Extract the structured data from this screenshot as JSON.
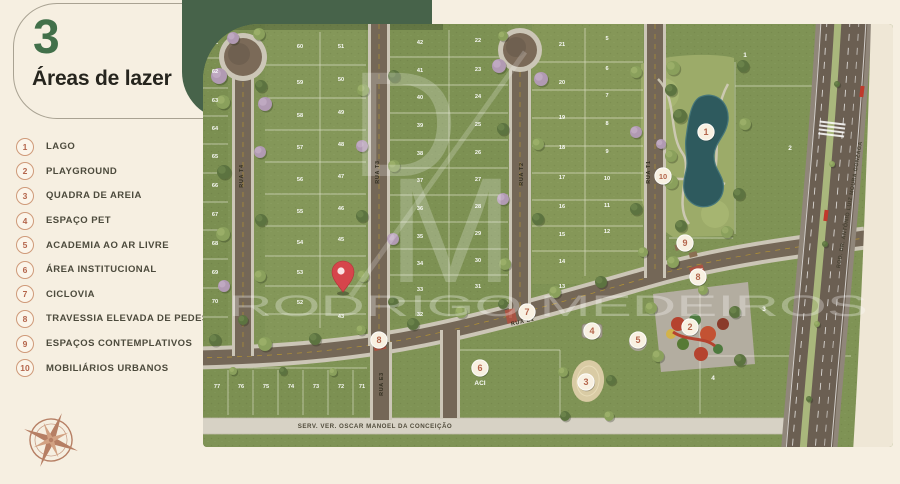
{
  "panel": {
    "section_number": "3",
    "title": "Áreas de lazer",
    "legend": [
      {
        "num": "1",
        "label": "LAGO"
      },
      {
        "num": "2",
        "label": "PLAYGROUND"
      },
      {
        "num": "3",
        "label": "QUADRA DE AREIA"
      },
      {
        "num": "4",
        "label": "ESPAÇO PET"
      },
      {
        "num": "5",
        "label": "ACADEMIA AO AR LIVRE"
      },
      {
        "num": "6",
        "label": "ÁREA INSTITUCIONAL"
      },
      {
        "num": "7",
        "label": "CICLOVIA"
      },
      {
        "num": "8",
        "label": "TRAVESSIA ELEVADA DE PEDESTRE"
      },
      {
        "num": "9",
        "label": "ESPAÇOS CONTEMPLATIVOS"
      },
      {
        "num": "10",
        "label": "MOBILIÁRIOS URBANOS"
      }
    ]
  },
  "watermark": {
    "monogram_d": "D",
    "monogram_m": "M",
    "name": "RODRIGO MEDEIROS"
  },
  "map": {
    "streets": [
      {
        "name": "RUA T4",
        "x": 40,
        "y": 152,
        "rot": -90,
        "cls": "street"
      },
      {
        "name": "RUA T3",
        "x": 176,
        "y": 148,
        "rot": -90,
        "cls": "street"
      },
      {
        "name": "RUA T2",
        "x": 320,
        "y": 150,
        "rot": -90,
        "cls": "street"
      },
      {
        "name": "RUA T1",
        "x": 447,
        "y": 148,
        "rot": -90,
        "cls": "street"
      },
      {
        "name": "RUA E1",
        "x": 320,
        "y": 299,
        "rot": -13,
        "cls": "street"
      },
      {
        "name": "RUA E3",
        "x": 180,
        "y": 360,
        "rot": -90,
        "cls": "street"
      },
      {
        "name": "SERV. VER. OSCAR MANOEL DA CONCEIÇÃO",
        "x": 172,
        "y": 404,
        "rot": 0,
        "cls": "serv"
      },
      {
        "name": "ROD. DR. ANTÔNIO LUIZ MOURA GONZAGA",
        "x": 648,
        "y": 181,
        "rot": -80,
        "cls": "rod"
      }
    ],
    "markers": [
      {
        "label": "1",
        "x": 503,
        "y": 108
      },
      {
        "label": "2",
        "x": 487,
        "y": 303
      },
      {
        "label": "3",
        "x": 383,
        "y": 358
      },
      {
        "label": "4",
        "x": 389,
        "y": 307
      },
      {
        "label": "5",
        "x": 435,
        "y": 316
      },
      {
        "label": "6",
        "x": 277,
        "y": 344
      },
      {
        "label": "7",
        "x": 324,
        "y": 288
      },
      {
        "label": "8",
        "x": 176,
        "y": 316
      },
      {
        "label": "8",
        "x": 495,
        "y": 253
      },
      {
        "label": "9",
        "x": 482,
        "y": 219
      },
      {
        "label": "10",
        "x": 460,
        "y": 152
      }
    ],
    "lots": [
      {
        "n": "61",
        "x": 12,
        "y": 20
      },
      {
        "n": "62",
        "x": 12,
        "y": 49
      },
      {
        "n": "63",
        "x": 12,
        "y": 78
      },
      {
        "n": "64",
        "x": 12,
        "y": 106
      },
      {
        "n": "65",
        "x": 12,
        "y": 134
      },
      {
        "n": "66",
        "x": 12,
        "y": 163
      },
      {
        "n": "67",
        "x": 12,
        "y": 192
      },
      {
        "n": "68",
        "x": 12,
        "y": 221
      },
      {
        "n": "69",
        "x": 12,
        "y": 250
      },
      {
        "n": "70",
        "x": 12,
        "y": 279
      },
      {
        "n": "77",
        "x": 14,
        "y": 364
      },
      {
        "n": "76",
        "x": 38,
        "y": 364
      },
      {
        "n": "75",
        "x": 63,
        "y": 364
      },
      {
        "n": "74",
        "x": 88,
        "y": 364
      },
      {
        "n": "73",
        "x": 113,
        "y": 364
      },
      {
        "n": "72",
        "x": 138,
        "y": 364
      },
      {
        "n": "71",
        "x": 159,
        "y": 364
      },
      {
        "n": "60",
        "x": 97,
        "y": 24
      },
      {
        "n": "59",
        "x": 97,
        "y": 60
      },
      {
        "n": "58",
        "x": 97,
        "y": 93
      },
      {
        "n": "57",
        "x": 97,
        "y": 125
      },
      {
        "n": "56",
        "x": 97,
        "y": 157
      },
      {
        "n": "55",
        "x": 97,
        "y": 189
      },
      {
        "n": "54",
        "x": 97,
        "y": 220
      },
      {
        "n": "53",
        "x": 97,
        "y": 250
      },
      {
        "n": "52",
        "x": 97,
        "y": 280
      },
      {
        "n": "51",
        "x": 138,
        "y": 24
      },
      {
        "n": "50",
        "x": 138,
        "y": 57
      },
      {
        "n": "49",
        "x": 138,
        "y": 90
      },
      {
        "n": "48",
        "x": 138,
        "y": 122
      },
      {
        "n": "47",
        "x": 138,
        "y": 154
      },
      {
        "n": "46",
        "x": 138,
        "y": 186
      },
      {
        "n": "45",
        "x": 138,
        "y": 217
      },
      {
        "n": "44",
        "x": 138,
        "y": 246
      },
      {
        "n": "43",
        "x": 138,
        "y": 294
      },
      {
        "n": "42",
        "x": 217,
        "y": 20
      },
      {
        "n": "41",
        "x": 217,
        "y": 48
      },
      {
        "n": "40",
        "x": 217,
        "y": 75
      },
      {
        "n": "39",
        "x": 217,
        "y": 103
      },
      {
        "n": "38",
        "x": 217,
        "y": 131
      },
      {
        "n": "37",
        "x": 217,
        "y": 158
      },
      {
        "n": "36",
        "x": 217,
        "y": 186
      },
      {
        "n": "35",
        "x": 217,
        "y": 214
      },
      {
        "n": "34",
        "x": 217,
        "y": 241
      },
      {
        "n": "33",
        "x": 217,
        "y": 267
      },
      {
        "n": "32",
        "x": 217,
        "y": 292
      },
      {
        "n": "22",
        "x": 275,
        "y": 18
      },
      {
        "n": "23",
        "x": 275,
        "y": 47
      },
      {
        "n": "24",
        "x": 275,
        "y": 74
      },
      {
        "n": "25",
        "x": 275,
        "y": 102
      },
      {
        "n": "26",
        "x": 275,
        "y": 130
      },
      {
        "n": "27",
        "x": 275,
        "y": 157
      },
      {
        "n": "28",
        "x": 275,
        "y": 184
      },
      {
        "n": "29",
        "x": 275,
        "y": 211
      },
      {
        "n": "30",
        "x": 275,
        "y": 238
      },
      {
        "n": "31",
        "x": 275,
        "y": 264
      },
      {
        "n": "21",
        "x": 359,
        "y": 22
      },
      {
        "n": "20",
        "x": 359,
        "y": 60
      },
      {
        "n": "19",
        "x": 359,
        "y": 95
      },
      {
        "n": "18",
        "x": 359,
        "y": 125
      },
      {
        "n": "17",
        "x": 359,
        "y": 155
      },
      {
        "n": "16",
        "x": 359,
        "y": 184
      },
      {
        "n": "15",
        "x": 359,
        "y": 212
      },
      {
        "n": "14",
        "x": 359,
        "y": 239
      },
      {
        "n": "13",
        "x": 359,
        "y": 264
      },
      {
        "n": "5",
        "x": 404,
        "y": 16
      },
      {
        "n": "6",
        "x": 404,
        "y": 46
      },
      {
        "n": "7",
        "x": 404,
        "y": 73
      },
      {
        "n": "8",
        "x": 404,
        "y": 101
      },
      {
        "n": "9",
        "x": 404,
        "y": 129
      },
      {
        "n": "10",
        "x": 404,
        "y": 156
      },
      {
        "n": "11",
        "x": 404,
        "y": 183
      },
      {
        "n": "12",
        "x": 404,
        "y": 209
      }
    ],
    "parcels": [
      {
        "n": "1",
        "x": 542,
        "y": 33
      },
      {
        "n": "2",
        "x": 587,
        "y": 126
      },
      {
        "n": "3",
        "x": 561,
        "y": 287
      },
      {
        "n": "4",
        "x": 510,
        "y": 356
      },
      {
        "n": "ACI",
        "x": 277,
        "y": 361
      }
    ],
    "pin": {
      "x": 140,
      "y": 268
    }
  },
  "colors": {
    "cream": "#f6efe1",
    "panel_green": "#47634a",
    "accent_number": "#42704a",
    "badge_text": "#b4654b",
    "badge_ring": "#cf9a79",
    "lawn": "#7f9355",
    "lake": "#2e5a5e",
    "road": "#746757",
    "terracotta": "#b07357",
    "pin_red": "#d6454b"
  }
}
